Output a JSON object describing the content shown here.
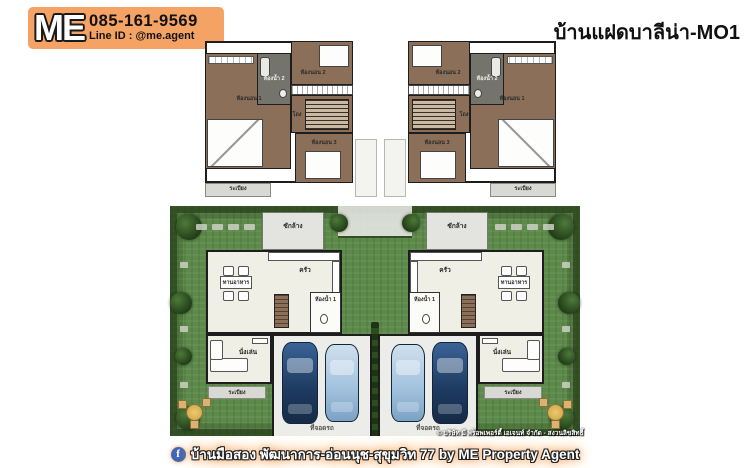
{
  "header": {
    "logo_text": "ME",
    "phone": "085-161-9569",
    "line_id": "Line ID : @me.agent",
    "title": "บ้านแฝดบาลีน่า-MO1"
  },
  "floor2": {
    "bedroom1": "ห้องนอน 1",
    "bedroom2": "ห้องนอน 2",
    "bedroom3": "ห้องนอน 3",
    "bathroom2": "ห้องน้ำ 2",
    "hall": "โถง",
    "balcony": "ระเบียง"
  },
  "floor1": {
    "laundry": "ซักล้าง",
    "kitchen": "ครัว",
    "dining": "ทานอาหาร",
    "living": "นั่งเล่น",
    "bathroom1": "ห้องน้ำ 1",
    "terrace": "ระเบียง",
    "parking": "ที่จอดรถ"
  },
  "watermark": "© บริษัท มี พร็อพเพอร์ตี้ เอเจนท์ จำกัด - สงวนลิขสิทธิ์",
  "footer": {
    "facebook_glyph": "f",
    "caption": "บ้านมือสอง พัฒนาการ-อ่อนนุช-สุขุมวิท 77 by ME Property Agent"
  },
  "colors": {
    "logo_orange": "#F5A265",
    "floor_brown": "#8B6F58",
    "bathroom_gray": "#74746D",
    "grass_green": "#5D8A4A",
    "hedge_green": "#2C4A20",
    "car_dark_blue": "#1D3A5F",
    "car_light_blue": "#9FC0DC",
    "facebook_blue": "#4267B2",
    "glow_orange": "#F09A4C"
  }
}
